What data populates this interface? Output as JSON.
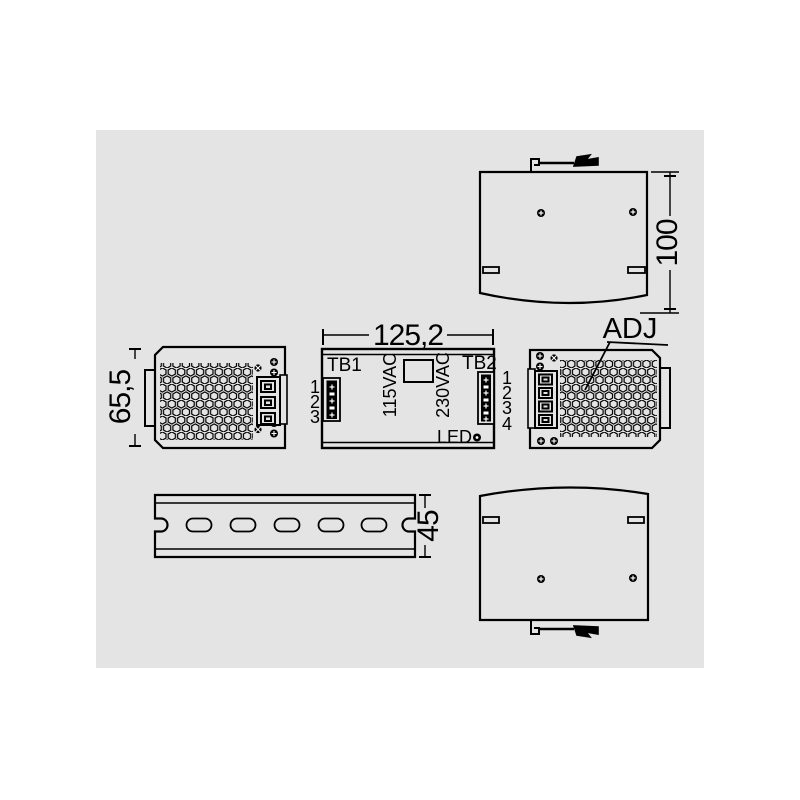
{
  "colors": {
    "page_bg": "#ffffff",
    "panel_bg": "#e4e4e4",
    "line": "#000000"
  },
  "dims": {
    "front_width": "125,2",
    "side_height": "65,5",
    "top_depth": "100",
    "rail_width": "45"
  },
  "front_view": {
    "tb1": "TB1",
    "tb2": "TB2",
    "v115": "115VAC",
    "v230": "230VAC",
    "led": "LED",
    "tb1_pins": [
      "1",
      "2",
      "3"
    ],
    "tb2_pins": [
      "1",
      "2",
      "3",
      "4"
    ]
  },
  "right_side_view": {
    "adj": "ADJ"
  }
}
